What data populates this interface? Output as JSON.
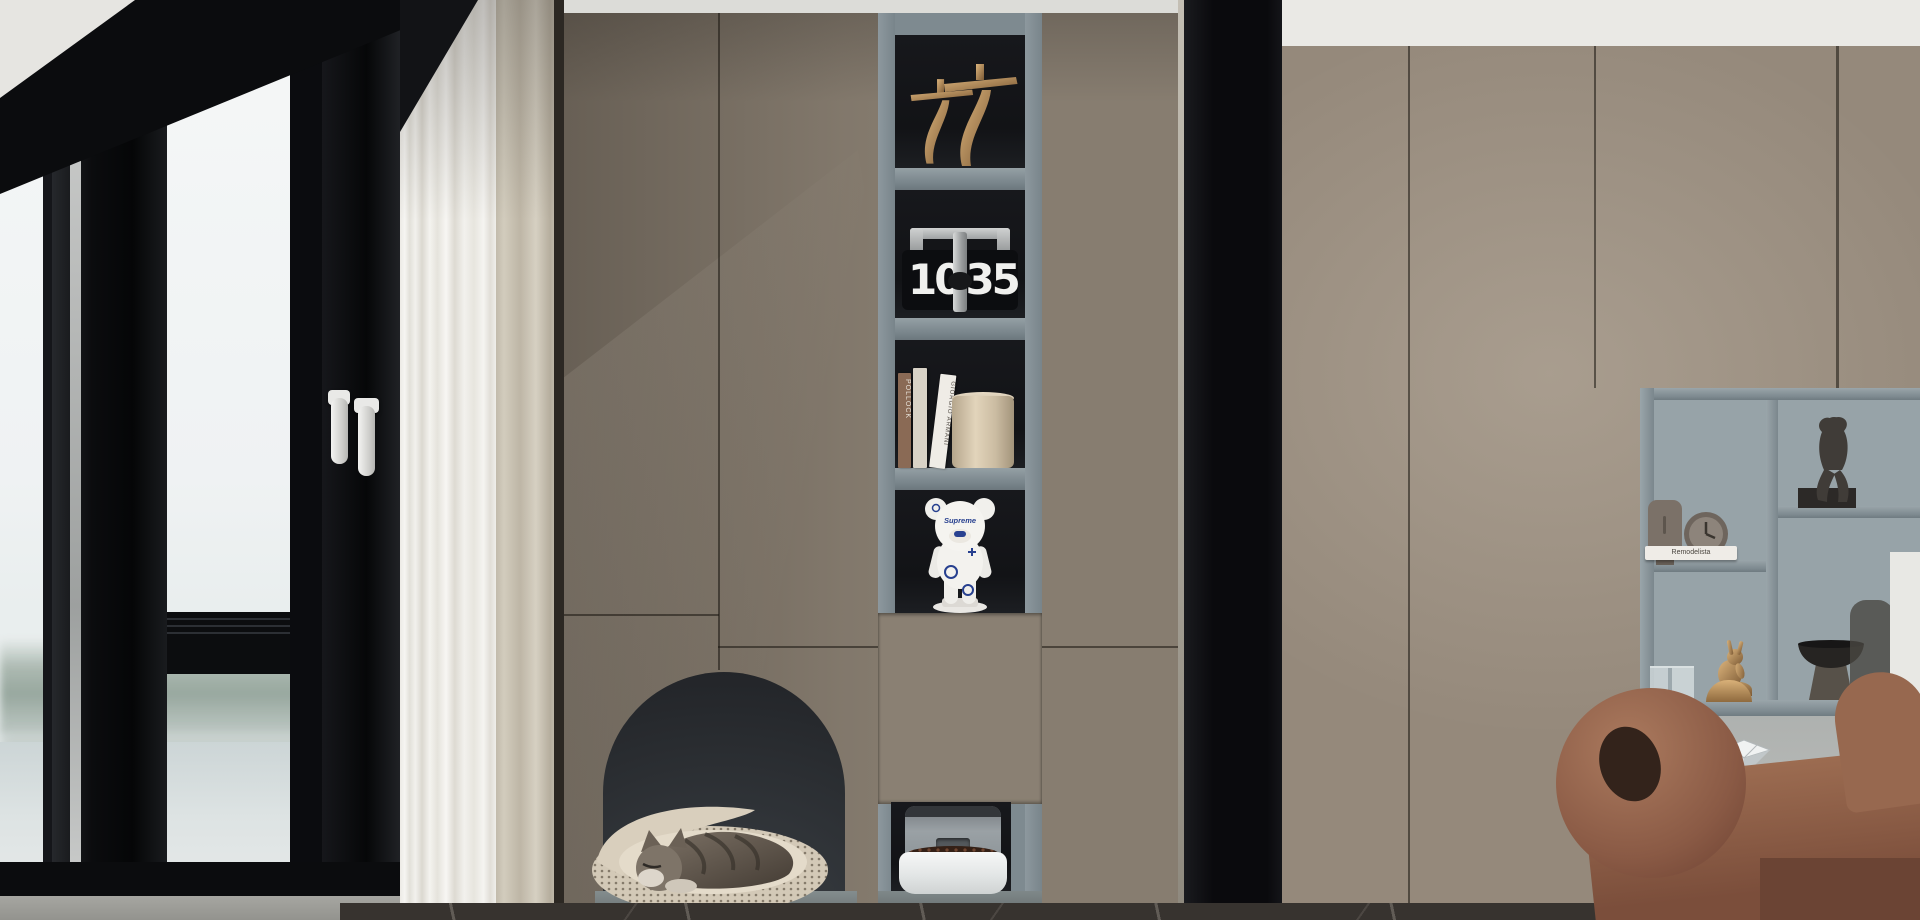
{
  "scene": {
    "description": "modern living room with built-in taupe wardrobe, corner window with lake view, arched cat nook and display niche",
    "objects": [
      "corner-window",
      "lake-view",
      "window-handles",
      "sheer-curtain",
      "beige-curtain",
      "cat-arch-nook",
      "sleeping-cat",
      "cat-bed",
      "gold-sculptures",
      "flip-clock",
      "books",
      "storage-cylinder",
      "bear-figurine",
      "pet-feeder",
      "black-column",
      "wardrobe-wall",
      "open-shelving",
      "seated-figure-sculpture",
      "face-vase",
      "desk-clock",
      "glass-cups",
      "gold-rabbit-figurine",
      "pedestal-bowl",
      "gold-lamp",
      "diamond-ornament",
      "plant-sprig",
      "side-table",
      "terracotta-armchair",
      "marble-floor"
    ]
  },
  "clock": {
    "hours": "10",
    "minutes": "35"
  },
  "books": {
    "spine_top": "POLLOCK",
    "spine_tilted": "GIORGIO ARMANI"
  },
  "bear": {
    "logo": "Supreme"
  },
  "right_shelf": {
    "book": "Remodelista"
  },
  "colors": {
    "cabinet_taupe": "#877d70",
    "wardrobe_taupe": "#95897b",
    "niche_grey_blue": "#7e8a90",
    "niche_interior": "#15161a",
    "arch_interior": "#2c2f33",
    "black_frame": "#0b0c0e",
    "sky": "#f0f3f4",
    "water": "#d3dbdc",
    "curtain_sheer": "#f2f1ed",
    "curtain_beige": "#cdc6b8",
    "armchair_brown": "#8f604a",
    "floor_marble": "#37332f",
    "gold": "#c9a26e",
    "bear_blue": "#27408f"
  }
}
